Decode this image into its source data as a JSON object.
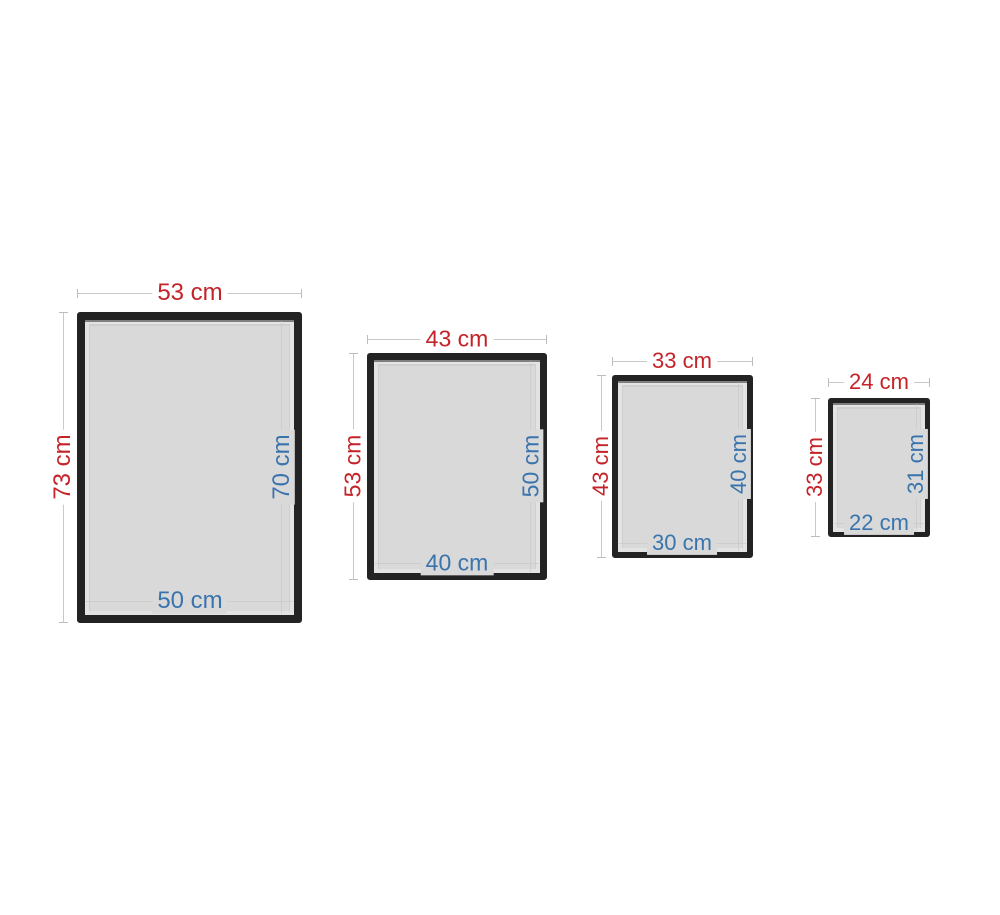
{
  "diagram": {
    "title": "picture-frame-set-dimensions",
    "unit": "cm",
    "outer_dimension_color": "#c42329",
    "inner_dimension_color": "#3a74ad",
    "frame_color": "#232323",
    "mat_color": "#d9d9d9",
    "dim_line_color": "#c9c9c9"
  },
  "frames": [
    {
      "outer_width": "53 cm",
      "outer_height": "73 cm",
      "inner_height": "70 cm",
      "inner_width": "50 cm"
    },
    {
      "outer_width": "43 cm",
      "outer_height": "53 cm",
      "inner_height": "50 cm",
      "inner_width": "40 cm"
    },
    {
      "outer_width": "33 cm",
      "outer_height": "43 cm",
      "inner_height": "40 cm",
      "inner_width": "30 cm"
    },
    {
      "outer_width": "24 cm",
      "outer_height": "33 cm",
      "inner_height": "31 cm",
      "inner_width": "22 cm"
    }
  ]
}
